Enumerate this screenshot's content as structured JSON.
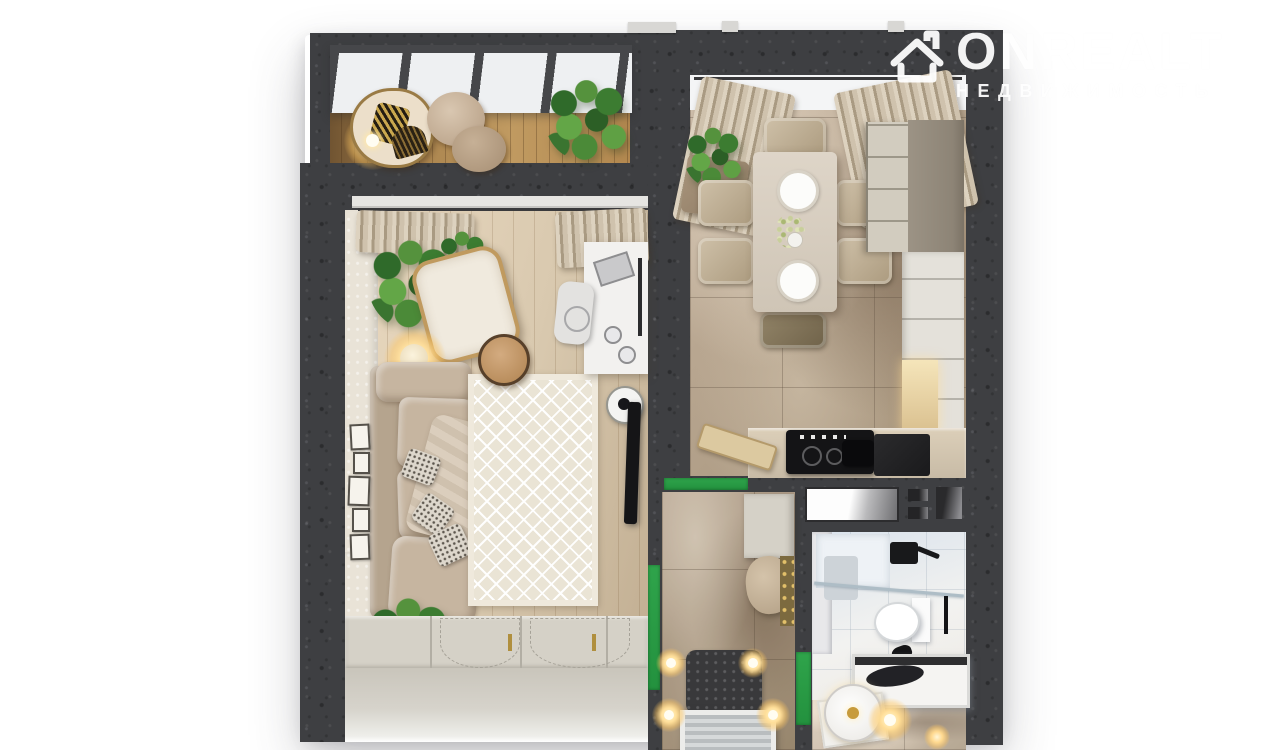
{
  "watermark": {
    "brand": "ONREALT",
    "tagline": "НЕДВИЖИМОСТЬ",
    "icon": "house-icon"
  },
  "scene": {
    "type": "3d-floorplan-top-view",
    "rooms": [
      {
        "id": "balcony",
        "features": [
          "glass-roof",
          "lounge-chair",
          "poufs",
          "plant",
          "floor-lamp"
        ]
      },
      {
        "id": "living-room",
        "features": [
          "curtains",
          "sofa",
          "pillows",
          "rug",
          "coffee-table",
          "armchair",
          "floor-lamp",
          "desk",
          "desk-chair",
          "tv",
          "speaker",
          "wardrobe",
          "picture-frames",
          "plants"
        ]
      },
      {
        "id": "kitchen-dining",
        "features": [
          "window",
          "curtains",
          "dining-table",
          "six-chairs",
          "plant",
          "cabinets",
          "cooktop",
          "counter"
        ]
      },
      {
        "id": "hallway",
        "features": [
          "storage-cabinet",
          "bench",
          "coat-hooks",
          "entry-rug",
          "doormat",
          "wall-sconces"
        ]
      },
      {
        "id": "bathroom",
        "features": [
          "shower",
          "glass-partition",
          "toilet",
          "bathtub",
          "vanity-mirror",
          "lights"
        ]
      }
    ],
    "door_markers": 3
  },
  "theme": {
    "background": "#ffffff",
    "wall": "#3e3f42",
    "door_marker": "#2fa44b",
    "living_floor": "#d9c9af",
    "balcony_floor": "#c09a61",
    "marble_floor": "#b7a591",
    "bath_floor": "#eceff2",
    "rug": "#eae4d5",
    "sofa": "#c6b5a0",
    "curtain": "#cfc2ad",
    "cabinet": "#d5d1c7",
    "counter": "#c8bba6",
    "glow": "#ffd98f",
    "watermark": "#ffffff"
  }
}
